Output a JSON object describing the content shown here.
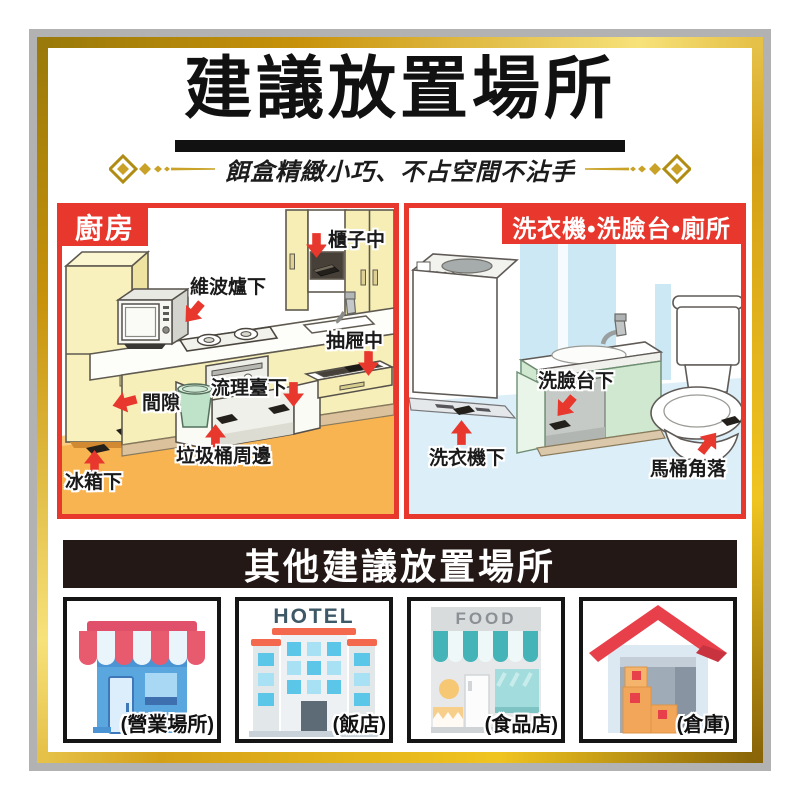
{
  "header": {
    "title": "建議放置場所",
    "subtitle": "餌盒精緻小巧、不占空間不沾手"
  },
  "panels": {
    "kitchen": {
      "badge": "廚房",
      "labels": [
        {
          "text": "櫃子中"
        },
        {
          "text": "維波爐下"
        },
        {
          "text": "抽屜中"
        },
        {
          "text": "流理臺下"
        },
        {
          "text": "間隙"
        },
        {
          "text": "垃圾桶周邊"
        },
        {
          "text": "冰箱下"
        }
      ]
    },
    "bathroom": {
      "badge": "洗衣機•洗臉台•廁所",
      "labels": [
        {
          "text": "洗臉台下"
        },
        {
          "text": "洗衣機下"
        },
        {
          "text": "馬桶角落"
        }
      ]
    }
  },
  "other_section": {
    "header": "其他建議放置場所",
    "items": [
      {
        "name": "storefront",
        "label": "(營業場所)"
      },
      {
        "name": "hotel",
        "label": "(飯店)",
        "sign": "HOTEL"
      },
      {
        "name": "food-store",
        "label": "(食品店)",
        "sign": "FOOD"
      },
      {
        "name": "warehouse",
        "label": "(倉庫)"
      }
    ]
  },
  "colors": {
    "accent_red": "#e8382d",
    "gold": "#c9a227",
    "dark_bar": "#231815",
    "kitchen_floor": "#f9b452",
    "bathroom_floor": "#dceef8"
  }
}
